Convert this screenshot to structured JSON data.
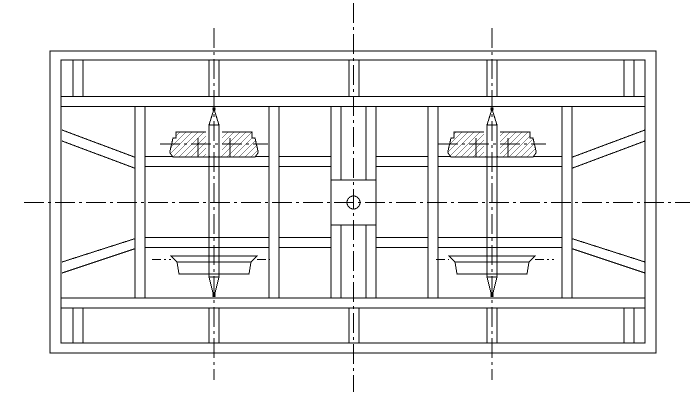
{
  "drawing": {
    "title": "frame-assembly-technical-drawing",
    "canvas": {
      "width": 693,
      "height": 401,
      "background": "#ffffff",
      "stroke": "#000000"
    },
    "frame": {
      "outer": [
        50,
        51,
        606,
        302
      ],
      "inner": [
        61,
        60,
        584,
        283
      ]
    },
    "rails": [
      [
        61,
        96.5,
        645,
        96.5
      ],
      [
        61,
        106.5,
        645,
        106.5
      ],
      [
        61,
        298,
        645,
        298
      ],
      [
        61,
        308,
        645,
        308
      ]
    ],
    "mid_rails": [
      [
        145,
        156.5,
        331,
        156.5
      ],
      [
        145,
        166.5,
        331,
        166.5
      ],
      [
        376,
        156.5,
        562,
        156.5
      ],
      [
        376,
        166.5,
        562,
        166.5
      ],
      [
        145,
        237.5,
        331,
        237.5
      ],
      [
        145,
        247.5,
        331,
        247.5
      ],
      [
        376,
        237.5,
        562,
        237.5
      ],
      [
        376,
        247.5,
        562,
        247.5
      ]
    ],
    "braces": [
      [
        62,
        130,
        137,
        158
      ],
      [
        62,
        141,
        137,
        169
      ],
      [
        62,
        262,
        137,
        238
      ],
      [
        62,
        273,
        137,
        248
      ],
      [
        645,
        130,
        570,
        158
      ],
      [
        645,
        141,
        570,
        169
      ],
      [
        645,
        262,
        570,
        238
      ],
      [
        645,
        273,
        570,
        248
      ]
    ],
    "member_lines": [
      [
        331,
        106.5,
        331,
        180
      ],
      [
        341,
        106.5,
        341,
        180
      ],
      [
        366,
        106.5,
        366,
        180
      ],
      [
        376,
        106.5,
        376,
        180
      ],
      [
        331,
        225,
        331,
        298
      ],
      [
        341,
        225,
        341,
        298
      ],
      [
        366,
        225,
        366,
        298
      ],
      [
        376,
        225,
        376,
        298
      ]
    ],
    "posts_top": {
      "y1": 60.5,
      "y2": 96.5,
      "x_pairs": [
        [
          73,
          83
        ],
        [
          209,
          219
        ],
        [
          349,
          359
        ],
        [
          487,
          497
        ],
        [
          624,
          634
        ]
      ]
    },
    "posts_bottom": {
      "y1": 308,
      "y2": 343,
      "x_pairs": [
        [
          73,
          83
        ],
        [
          209,
          219
        ],
        [
          349,
          359
        ],
        [
          487,
          497
        ],
        [
          624,
          634
        ]
      ]
    },
    "columns": [
      [
        135,
        106.5,
        10,
        191.5
      ],
      [
        269,
        106.5,
        10,
        191.5
      ],
      [
        428,
        106.5,
        10,
        191.5
      ],
      [
        562,
        106.5,
        10,
        191.5
      ]
    ],
    "center_block": {
      "rect": [
        331,
        180,
        45,
        45
      ],
      "circle": [
        353.5,
        202.5,
        6.5
      ]
    },
    "bearings": [
      {
        "outline": [
          [
            176,
            132
          ],
          [
            252,
            132
          ],
          [
            252,
            138
          ],
          [
            255,
            138
          ],
          [
            258,
            151
          ],
          [
            258,
            153
          ],
          [
            255,
            157
          ],
          [
            173,
            157
          ],
          [
            170,
            153
          ],
          [
            170,
            151
          ],
          [
            173,
            138
          ],
          [
            176,
            138
          ]
        ],
        "steps": [
          [
            198,
            138,
            198,
            157
          ],
          [
            230,
            138,
            230,
            157
          ]
        ],
        "bore": [
          206,
          131.5,
          16,
          24.5
        ]
      },
      {
        "outline": [
          [
            454,
            132
          ],
          [
            530,
            132
          ],
          [
            530,
            138
          ],
          [
            533,
            138
          ],
          [
            536,
            151
          ],
          [
            536,
            153
          ],
          [
            533,
            157
          ],
          [
            451,
            157
          ],
          [
            448,
            153
          ],
          [
            448,
            151
          ],
          [
            451,
            138
          ],
          [
            454,
            138
          ]
        ],
        "steps": [
          [
            476,
            138,
            476,
            157
          ],
          [
            508,
            138,
            508,
            157
          ]
        ],
        "bore": [
          484,
          131.5,
          16,
          24.5
        ]
      }
    ],
    "pans": [
      {
        "outline": [
          [
            171,
            256
          ],
          [
            257,
            256
          ],
          [
            251,
            262
          ],
          [
            249,
            274
          ],
          [
            179,
            274
          ],
          [
            177,
            262
          ]
        ],
        "inner_line": [
          177,
          262,
          251,
          262
        ]
      },
      {
        "outline": [
          [
            449,
            256
          ],
          [
            535,
            256
          ],
          [
            529,
            262
          ],
          [
            527,
            274
          ],
          [
            457,
            274
          ],
          [
            455,
            262
          ]
        ],
        "inner_line": [
          455,
          262,
          529,
          262
        ]
      }
    ],
    "shafts": [
      {
        "lines": [
          [
            209,
            125,
            209,
            277
          ],
          [
            219,
            125,
            219,
            277
          ]
        ],
        "top_cone": [
          [
            209,
            125
          ],
          [
            214,
            109
          ],
          [
            219,
            125
          ]
        ],
        "bottom_cone": [
          [
            209,
            277
          ],
          [
            214,
            297
          ],
          [
            219,
            277
          ]
        ],
        "dots": [
          [
            214,
            109
          ],
          [
            214,
            295.5
          ]
        ]
      },
      {
        "lines": [
          [
            487,
            125,
            487,
            277
          ],
          [
            497,
            125,
            497,
            277
          ]
        ],
        "top_cone": [
          [
            487,
            125
          ],
          [
            492,
            109
          ],
          [
            497,
            125
          ]
        ],
        "bottom_cone": [
          [
            487,
            277
          ],
          [
            492,
            297
          ],
          [
            497,
            277
          ]
        ],
        "dots": [
          [
            492,
            109
          ],
          [
            492,
            295.5
          ]
        ]
      }
    ],
    "centerlines": {
      "main": [
        [
          24,
          202.5,
          690,
          202.5
        ],
        [
          353.5,
          3,
          353.5,
          392
        ]
      ],
      "shaft": [
        [
          214,
          28,
          214,
          380
        ],
        [
          492,
          28,
          492,
          380
        ]
      ],
      "bearing": [
        [
          160,
          144,
          268,
          144
        ],
        [
          438,
          144,
          546,
          144
        ]
      ],
      "ticks": [
        [
          152,
          259.5,
          171,
          259.5
        ],
        [
          257,
          259.5,
          270,
          259.5
        ],
        [
          436,
          259.5,
          449,
          259.5
        ],
        [
          535,
          259.5,
          554,
          259.5
        ]
      ]
    }
  }
}
